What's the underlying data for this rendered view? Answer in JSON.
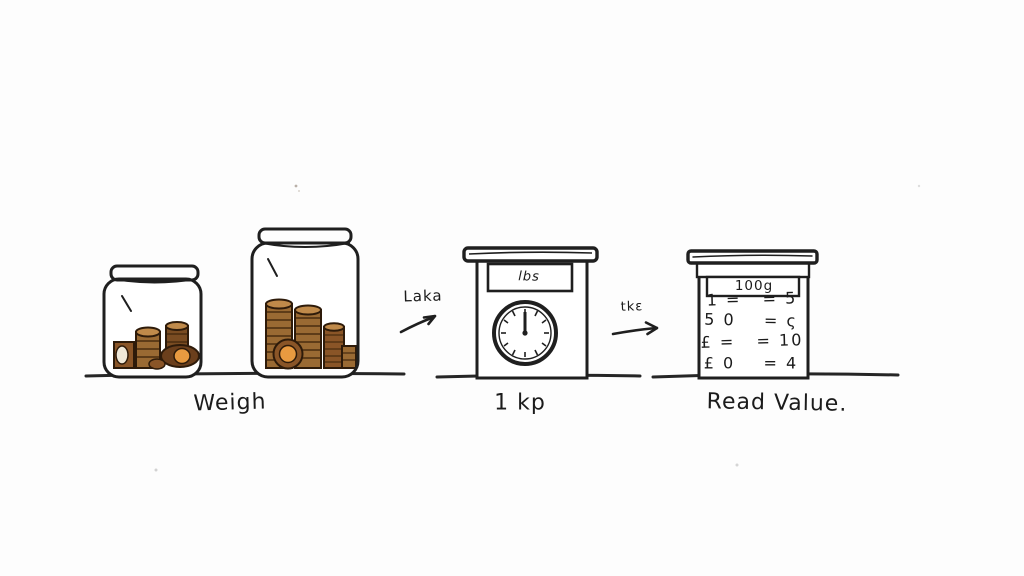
{
  "steps": {
    "weigh": "Weigh",
    "scale": "1 kp",
    "read": "Read Value."
  },
  "annotations": {
    "arrow1_label": "Laka",
    "arrow2_label": "tkε"
  },
  "scale": {
    "display": "lbs"
  },
  "chart": {
    "header": "100g",
    "rows": [
      "1 =   = 5",
      "5 0    = ς",
      "£ =   = 10",
      "£ 0    = 4"
    ]
  },
  "chart_data": {
    "type": "table",
    "title": "100g",
    "rows": [
      [
        "1 =",
        "= 5"
      ],
      [
        "50",
        "= ς"
      ],
      [
        "£ =",
        "= 10"
      ],
      [
        "£0",
        "= 4"
      ]
    ]
  },
  "colors": {
    "ink": "#1f1f1f",
    "coin_brown": "#9a6a33",
    "coin_dark_brown": "#6b3f1c",
    "coin_orange": "#e89a40",
    "coin_top": "#c08a4a",
    "paper": "#fdfdfd"
  }
}
